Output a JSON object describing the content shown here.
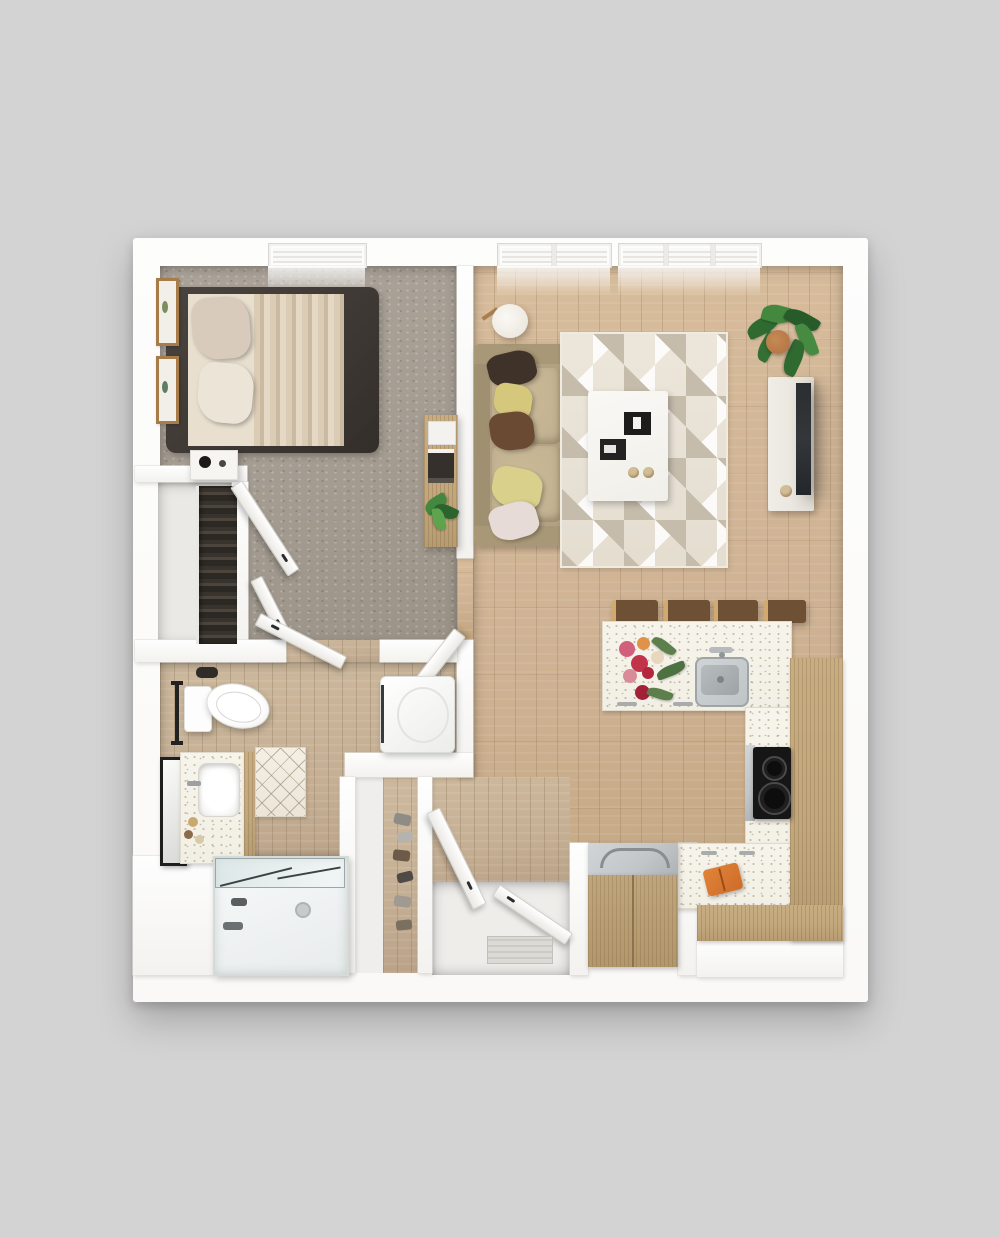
{
  "scene": {
    "type": "floor-plan-3d-top-view",
    "unit": "one-bedroom one-bath apartment",
    "rooms": [
      {
        "name": "bedroom",
        "floor": "carpet",
        "items": [
          "platform-bed",
          "pillows",
          "pleated-blanket",
          "nightstand",
          "table-lamp",
          "wall-art-frames",
          "window",
          "bifold-closet-doors",
          "wood-console-desk",
          "entry-door"
        ]
      },
      {
        "name": "closet",
        "floor": "laminate",
        "items": [
          "wardrobe-shelving"
        ]
      },
      {
        "name": "bathroom",
        "floor": "wood-tile",
        "items": [
          "toilet",
          "towel-bar",
          "vanity-with-sink",
          "leaning-mirror",
          "bath-mat",
          "bathtub-with-glass-screen",
          "washer-dryer",
          "door"
        ]
      },
      {
        "name": "living-room",
        "floor": "hardwood",
        "items": [
          "sofa",
          "throw-pillows",
          "floor-lamp",
          "geometric-area-rug",
          "coffee-table",
          "serving-trays",
          "tv-console",
          "tv",
          "potted-plant",
          "two-windows"
        ]
      },
      {
        "name": "kitchen",
        "floor": "hardwood",
        "items": [
          "peninsula-island",
          "bar-stools",
          "stainless-sink",
          "faucet",
          "flower-arrangement",
          "cooktop",
          "l-shaped-counter",
          "wood-cabinets",
          "refrigerator",
          "orange-bag"
        ]
      },
      {
        "name": "entry",
        "floor": "tile",
        "items": [
          "front-door",
          "coat-closet-door",
          "door-mat",
          "shoe-closet",
          "shoes"
        ]
      }
    ]
  },
  "palette": {
    "bg": "#d3d3d4",
    "wall": "#faf9f7",
    "carpet": "#a49c91",
    "wood": "#ceb293",
    "woodBath": "#c5af94",
    "counter": "#f2efe5",
    "cabinet": "#c2a77c",
    "steel": "#c2c6c8",
    "cooktop": "#161616",
    "bedFrame": "#3e3834",
    "mattress": "#e8dfcf",
    "sofa": "#b2a284",
    "sofaCushion": "#c0b091",
    "pillowBrownDark": "#3f3228",
    "pillowYellow": "#d5c87d",
    "pillowBrown": "#6b4a33",
    "pillowBlush": "#e6dbd7",
    "rugBase": "#e4ddd0",
    "rugTri": "#c6bcac",
    "tvDark": "#33373a",
    "plant": "#44883f",
    "terracotta": "#b07140",
    "matBase": "#ece6d8",
    "orange": "#ce6b29",
    "mirrorFrame": "#1e1e1e",
    "doormat": "#dcdad4",
    "knobTan": "#d3bd95"
  }
}
